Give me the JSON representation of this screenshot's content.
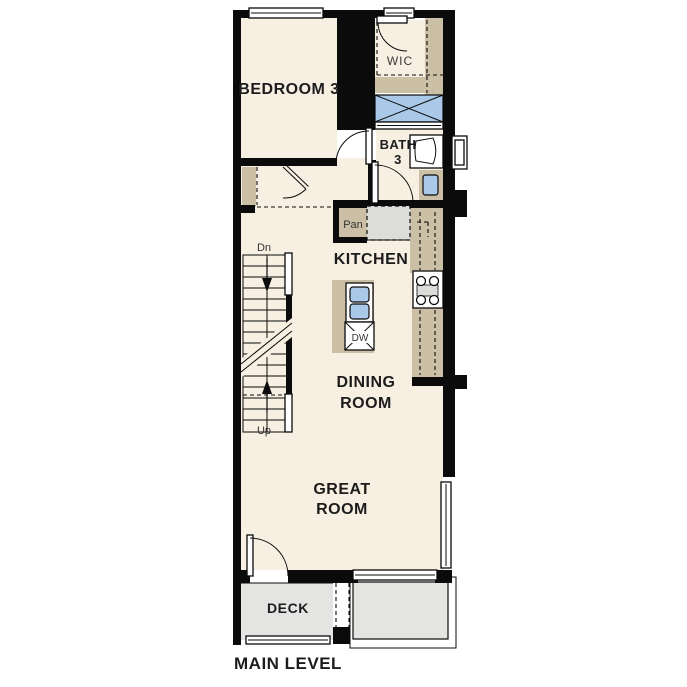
{
  "plan": {
    "title": "MAIN LEVEL",
    "labels": {
      "bedroom3": "BEDROOM 3",
      "wic": "WIC",
      "bath_line1": "BATH",
      "bath_line2": "3",
      "pantry": "Pan",
      "kitchen": "KITCHEN",
      "dishwasher": "DW",
      "stairs_down": "Dn",
      "stairs_up": "Up",
      "dining_line1": "DINING",
      "dining_line2": "ROOM",
      "great_line1": "GREAT",
      "great_line2": "ROOM",
      "deck": "DECK"
    },
    "colors": {
      "page_bg": "#ffffff",
      "wall": "#0b0b0b",
      "floor": "#f6efe2",
      "cabinet_tan": "#cbbfa6",
      "fixture_blue": "#aac9e8",
      "deck_gray": "#e4e4e2",
      "appliance_gray": "#dcdcda"
    }
  }
}
